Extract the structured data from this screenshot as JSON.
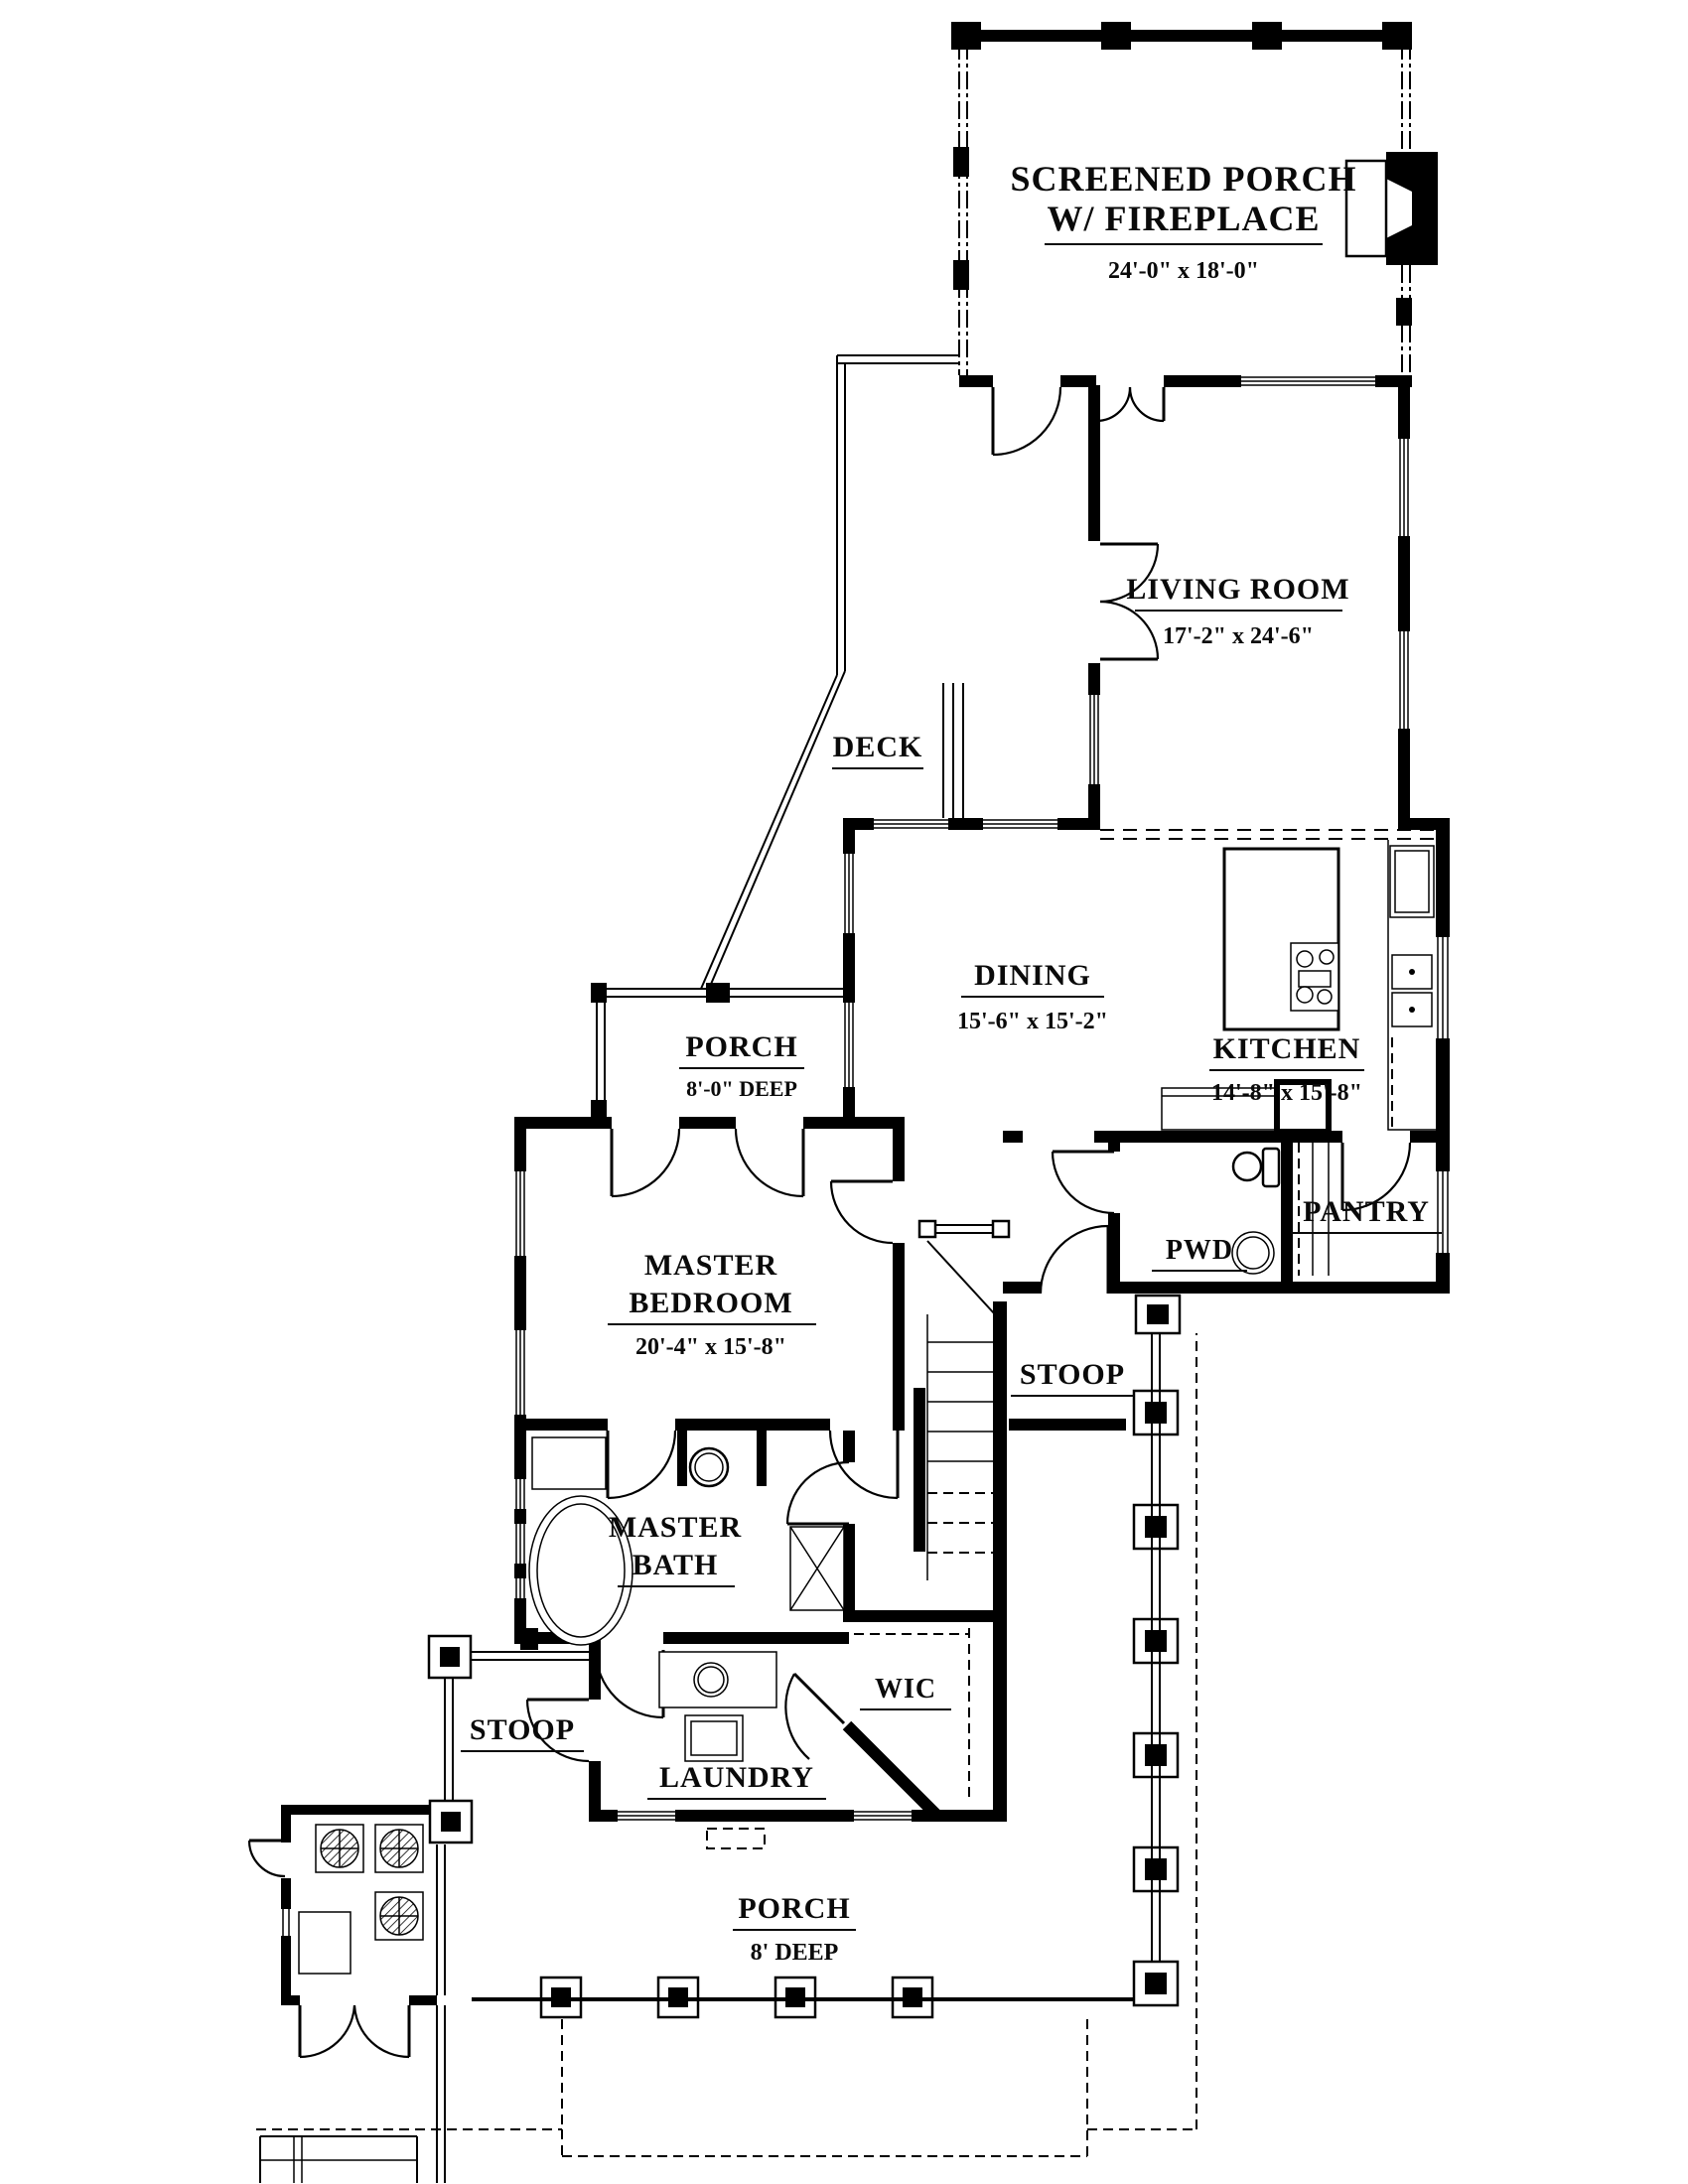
{
  "plan": {
    "rooms": {
      "screened_porch": {
        "name1": "SCREENED PORCH",
        "name2": "W/ FIREPLACE",
        "dims": "24'-0\" x 18'-0\""
      },
      "living_room": {
        "name": "LIVING ROOM",
        "dims": "17'-2\" x 24'-6\""
      },
      "deck": {
        "name": "DECK"
      },
      "dining": {
        "name": "DINING",
        "dims": "15'-6\" x 15'-2\""
      },
      "kitchen": {
        "name": "KITCHEN",
        "dims": "14'-8\" x 15'-8\""
      },
      "porch_mid": {
        "name": "PORCH",
        "dims": "8'-0\" DEEP"
      },
      "pantry": {
        "name": "PANTRY"
      },
      "powder": {
        "name": "PWD"
      },
      "master_bedroom": {
        "name1": "MASTER",
        "name2": "BEDROOM",
        "dims": "20'-4\" x 15'-8\""
      },
      "stoop_right": {
        "name": "STOOP"
      },
      "master_bath": {
        "name1": "MASTER",
        "name2": "BATH"
      },
      "wic": {
        "name": "WIC"
      },
      "stoop_left": {
        "name": "STOOP"
      },
      "laundry": {
        "name": "LAUNDRY"
      },
      "porch_bottom": {
        "name": "PORCH",
        "dims": "8' DEEP"
      }
    },
    "fixtures": [
      "fireplace-icon",
      "kitchen-island-icon",
      "cooktop-icon",
      "double-sink-icon",
      "refrigerator-icon",
      "range-icon",
      "toilet-icon",
      "round-sink-icon",
      "bathtub-icon",
      "vanity-icon",
      "shower-icon",
      "stair-icon",
      "washer-icon",
      "laundry-sink-icon",
      "ceiling-fan-icon",
      "porch-column-icon"
    ],
    "colors": {
      "ink": "#000000",
      "paper": "#ffffff"
    }
  }
}
